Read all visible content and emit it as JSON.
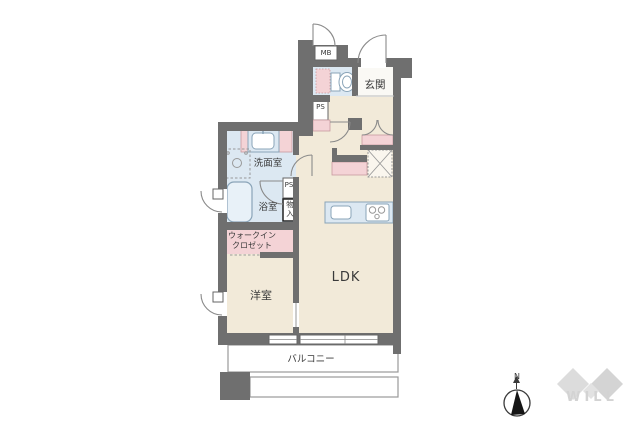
{
  "plan": {
    "labels": {
      "meter_box": "MB",
      "entrance": "玄関",
      "pipe_space": "PS",
      "washroom": "洗面室",
      "bathroom": "浴室",
      "storage": "物入",
      "walk_in_closet": "ウォークインクロゼット",
      "western_room": "洋室",
      "ldk": "LDK",
      "balcony": "バルコニー"
    },
    "compass": {
      "north_label": "N"
    },
    "watermark": {
      "logo_text": "WILL"
    },
    "colors": {
      "wall": "#6f6f6f",
      "floor_main": "#f2ead9",
      "floor_wet": "#dce8f2",
      "accent_pink": "#f4d3d6",
      "entrance_floor": "#faf9f5",
      "fixture_border": "#8aa4b8",
      "line": "#8a8a8a",
      "thin": "#999999",
      "text": "#3a3a3a",
      "watermark": "#d3d3d3",
      "fridge_fill": "#faf6ee"
    }
  }
}
